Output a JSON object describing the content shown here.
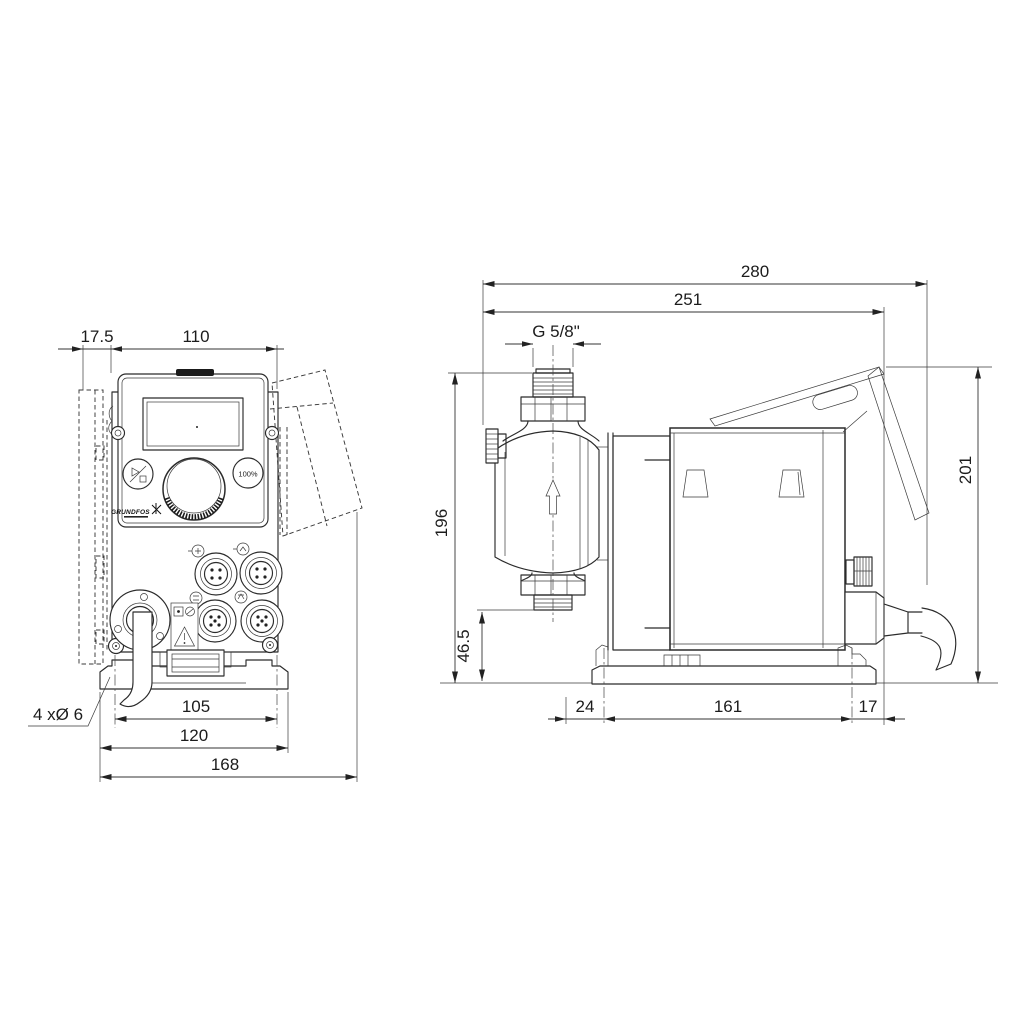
{
  "drawing": {
    "title": "Dosing pump dimensional drawing",
    "units": "mm"
  },
  "front_view": {
    "dim_offset": "17.5",
    "dim_width": "110",
    "dim_holes": "105",
    "dim_plate": "120",
    "dim_total": "168",
    "note_holes": "4 xØ 6",
    "panel": {
      "percent_button": "100%",
      "logo": "GRUNDFOS"
    }
  },
  "side_view": {
    "dim_total_depth": "280",
    "dim_depth": "251",
    "thread_label": "G 5/8\"",
    "dim_height": "196",
    "dim_valve_height": "46.5",
    "dim_plate_height": "201",
    "dim_front": "24",
    "dim_base": "161",
    "dim_rear": "17"
  },
  "colors": {
    "line": "#2b2b2b",
    "dim": "#333333",
    "text": "#1c1c1c",
    "background": "#ffffff"
  }
}
